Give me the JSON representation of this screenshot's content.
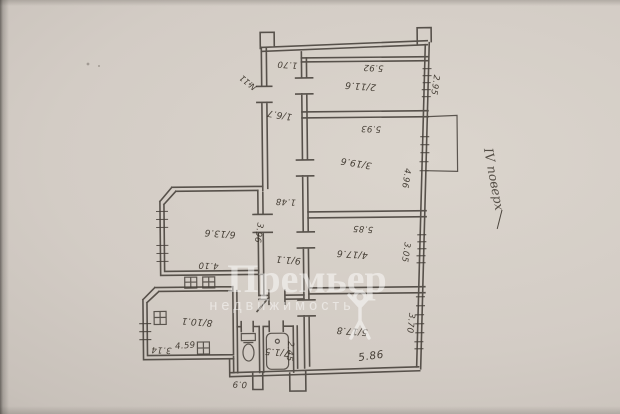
{
  "watermark": {
    "brand": "Премьер",
    "tagline": "недвижимость"
  },
  "notes": {
    "floor": "IV поверх",
    "apartment_mark": "№11"
  },
  "plan": {
    "room_labels": [
      {
        "room": "hall",
        "text": "1/6.7"
      },
      {
        "room": "room-2",
        "text": "2/11.6"
      },
      {
        "room": "room-3",
        "text": "3/19.6"
      },
      {
        "room": "room-4",
        "text": "4/17.6"
      },
      {
        "room": "room-5",
        "text": "5/17.8"
      },
      {
        "room": "room-6",
        "text": "6/13.6"
      },
      {
        "room": "hall-small",
        "text": "9/1.1"
      },
      {
        "room": "bathroom",
        "text": "7/1.5"
      },
      {
        "room": "kitchen",
        "text": "8/10.1"
      }
    ],
    "dimensions": [
      {
        "edge": "hall-width",
        "text": "1.70"
      },
      {
        "edge": "room-2-width",
        "text": "5.92"
      },
      {
        "edge": "room-2-depth",
        "text": "2.95"
      },
      {
        "edge": "room-3-width",
        "text": "5.93"
      },
      {
        "edge": "room-3-depth",
        "text": "4.96"
      },
      {
        "edge": "room-4-width",
        "text": "5.85"
      },
      {
        "edge": "room-4-depth",
        "text": "3.05"
      },
      {
        "edge": "room-5-width",
        "text": "5.86"
      },
      {
        "edge": "room-5-depth",
        "text": "3.70"
      },
      {
        "edge": "room-6-depth",
        "text": "3.96"
      },
      {
        "edge": "room-6-width",
        "text": "4.10"
      },
      {
        "edge": "vestibule-width",
        "text": "1.48"
      },
      {
        "edge": "bathroom-depth",
        "text": "2.45"
      },
      {
        "edge": "toilet-width",
        "text": "0.9"
      },
      {
        "edge": "kitchen-left",
        "text": "3.14"
      },
      {
        "edge": "kitchen-width",
        "text": "4.59"
      }
    ]
  }
}
